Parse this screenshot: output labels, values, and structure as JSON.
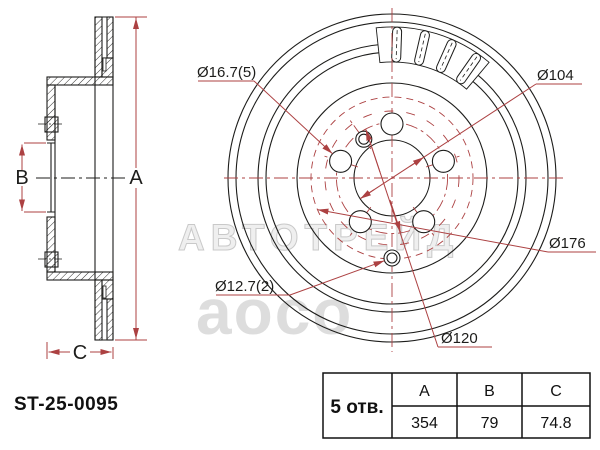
{
  "part_number": "ST-25-0095",
  "colors": {
    "line": "#1d1d1b",
    "dimension_red": "#ac4142",
    "watermark_gray": "#d5d5d5"
  },
  "side_view": {
    "label_a": "A",
    "label_b": "B",
    "label_c": "C"
  },
  "front_view": {
    "label_bolt_holes": "Ø16.7(5)",
    "label_center_bore": "Ø104",
    "label_hub_face": "Ø176",
    "label_pin_holes": "Ø12.7(2)",
    "label_pcd": "Ø120"
  },
  "watermarks": {
    "brand": "АВТОТРЕЙД",
    "logo": "aoco"
  },
  "table": {
    "holes_label": "5 отв.",
    "headers": [
      "A",
      "B",
      "C"
    ],
    "values": [
      "354",
      "79",
      "74.8"
    ]
  }
}
